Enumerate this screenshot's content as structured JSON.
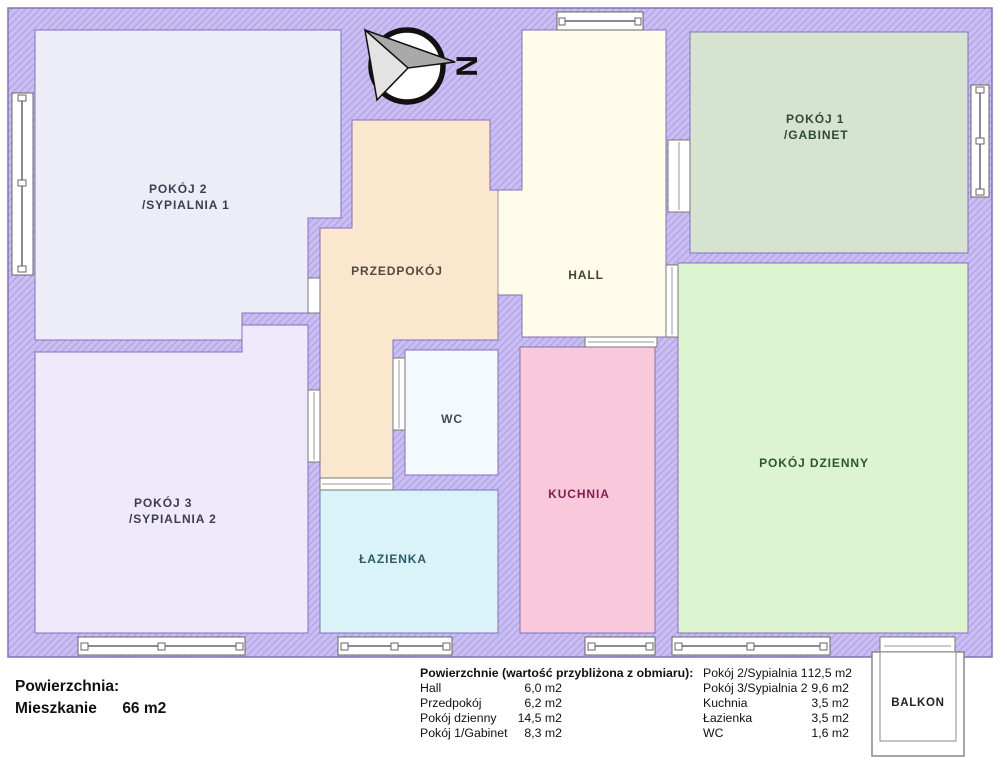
{
  "compass": {
    "north_label": "N"
  },
  "colors": {
    "wall_base": "#cabdf1",
    "wall_hatch": "#b2a1e6",
    "wall_outline": "#8073bb",
    "window_fill": "#ffffff",
    "frame": "#6b6b6b",
    "divider": "#9a9a9a"
  },
  "rooms": {
    "pokoj2": {
      "line1": "POKÓJ 2",
      "line2": "/SYPIALNIA 1",
      "color": "#ededf8",
      "label_color": "#3d3d52"
    },
    "pokoj3": {
      "line1": "POKÓJ 3",
      "line2": "/SYPIALNIA 2",
      "color": "#efe9fb",
      "label_color": "#3d3d52"
    },
    "przedpokoj": {
      "line1": "PRZEDPOKÓJ",
      "color": "#fae7cd",
      "label_color": "#554840"
    },
    "hall": {
      "line1": "HALL",
      "color": "#fffce9",
      "label_color": "#44442f"
    },
    "wc": {
      "line1": "WC",
      "color": "#f3fafd",
      "label_color": "#3e4e58"
    },
    "lazienka": {
      "line1": "ŁAZIENKA",
      "color": "#d9f3f9",
      "label_color": "#2e5a66"
    },
    "kuchnia": {
      "line1": "KUCHNIA",
      "color": "#f9c8da",
      "label_color": "#7c2350"
    },
    "pokoj1": {
      "line1": "POKÓJ 1",
      "line2": "/GABINET",
      "color": "#d6e3d1",
      "label_color": "#2f4a33"
    },
    "dzienny": {
      "line1": "POKÓJ DZIENNY",
      "color": "#dcf5d0",
      "label_color": "#2d5434"
    },
    "balkon": {
      "line1": "BALKON",
      "color": "#ffffff",
      "label_color": "#222222"
    }
  },
  "footer": {
    "summary_title": "Powierzchnia:",
    "summary_name": "Mieszkanie",
    "summary_value": "66 m2",
    "table_title": "Powierzchnie (wartość przybliżona z obmiaru):",
    "col1": [
      {
        "name": "Hall",
        "value": "6,0 m2"
      },
      {
        "name": "Przedpokój",
        "value": "6,2 m2"
      },
      {
        "name": "Pokój dzienny",
        "value": "14,5 m2"
      },
      {
        "name": "Pokój 1/Gabinet",
        "value": "8,3 m2"
      }
    ],
    "col2": [
      {
        "name": "Pokój 2/Sypialnia 1",
        "value": "12,5 m2"
      },
      {
        "name": "Pokój 3/Sypialnia 2",
        "value": "9,6 m2"
      },
      {
        "name": "Kuchnia",
        "value": "3,5 m2"
      },
      {
        "name": "Łazienka",
        "value": "3,5 m2"
      },
      {
        "name": "WC",
        "value": "1,6 m2"
      }
    ]
  }
}
